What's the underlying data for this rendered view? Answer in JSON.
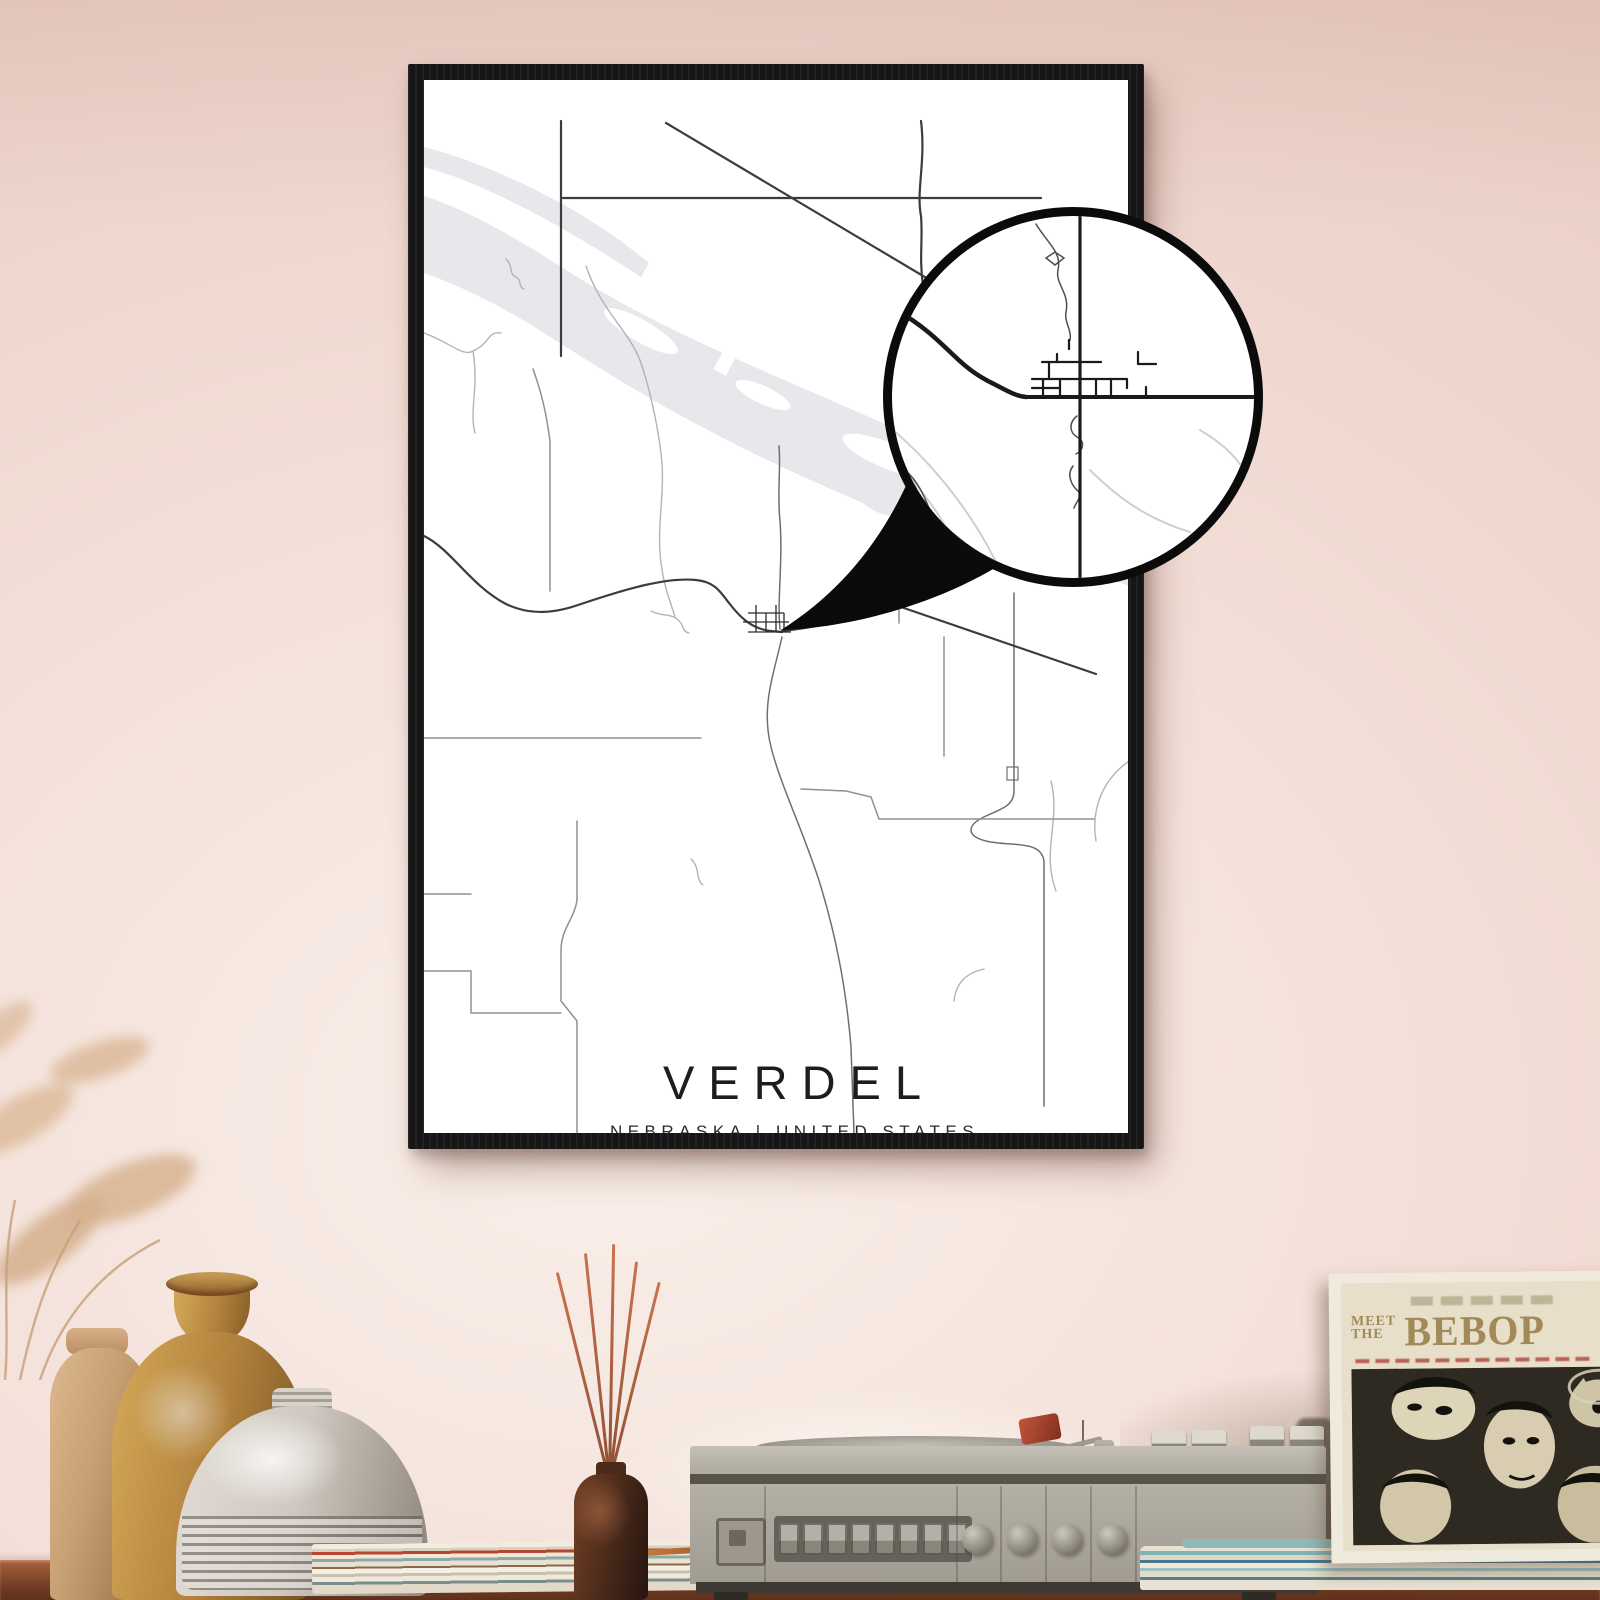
{
  "poster": {
    "title": "VERDEL",
    "subtitle": "NEBRASKA | UNITED STATES",
    "coordinates": "42.8113°N / 98.1932°W"
  },
  "album": {
    "pretitle_line1": "MEET",
    "pretitle_line2": "THE",
    "title": "BEBOP"
  },
  "colors": {
    "wall": "#ecd3ca",
    "wall_light": "#f9efe9",
    "frame": "#161616",
    "poster_bg": "#ffffff",
    "map_road": "#3c3c3c",
    "map_road_light": "#909090",
    "map_water": "#e8e8ec",
    "map_stream": "#b3b3b3",
    "magnifier_ring": "#0b0b0b",
    "ink": "#1d1d1d",
    "shelf_wood": "#8a4f31",
    "player_body": "#b2ada3",
    "album_cream": "#e7dfc9",
    "album_ink": "#2e2a21",
    "album_text": "#a18a58",
    "vase_ochre": "#b3833d",
    "vase_white": "#cfc8c0",
    "vase_tan": "#c79f74",
    "diffuser_bottle": "#46281a",
    "reed_sticks": "#b65c3d",
    "pampas": "#d9b695",
    "records_teal": "#7fb3b5"
  },
  "icons": {
    "magnifier": "magnifier-circle-icon"
  }
}
